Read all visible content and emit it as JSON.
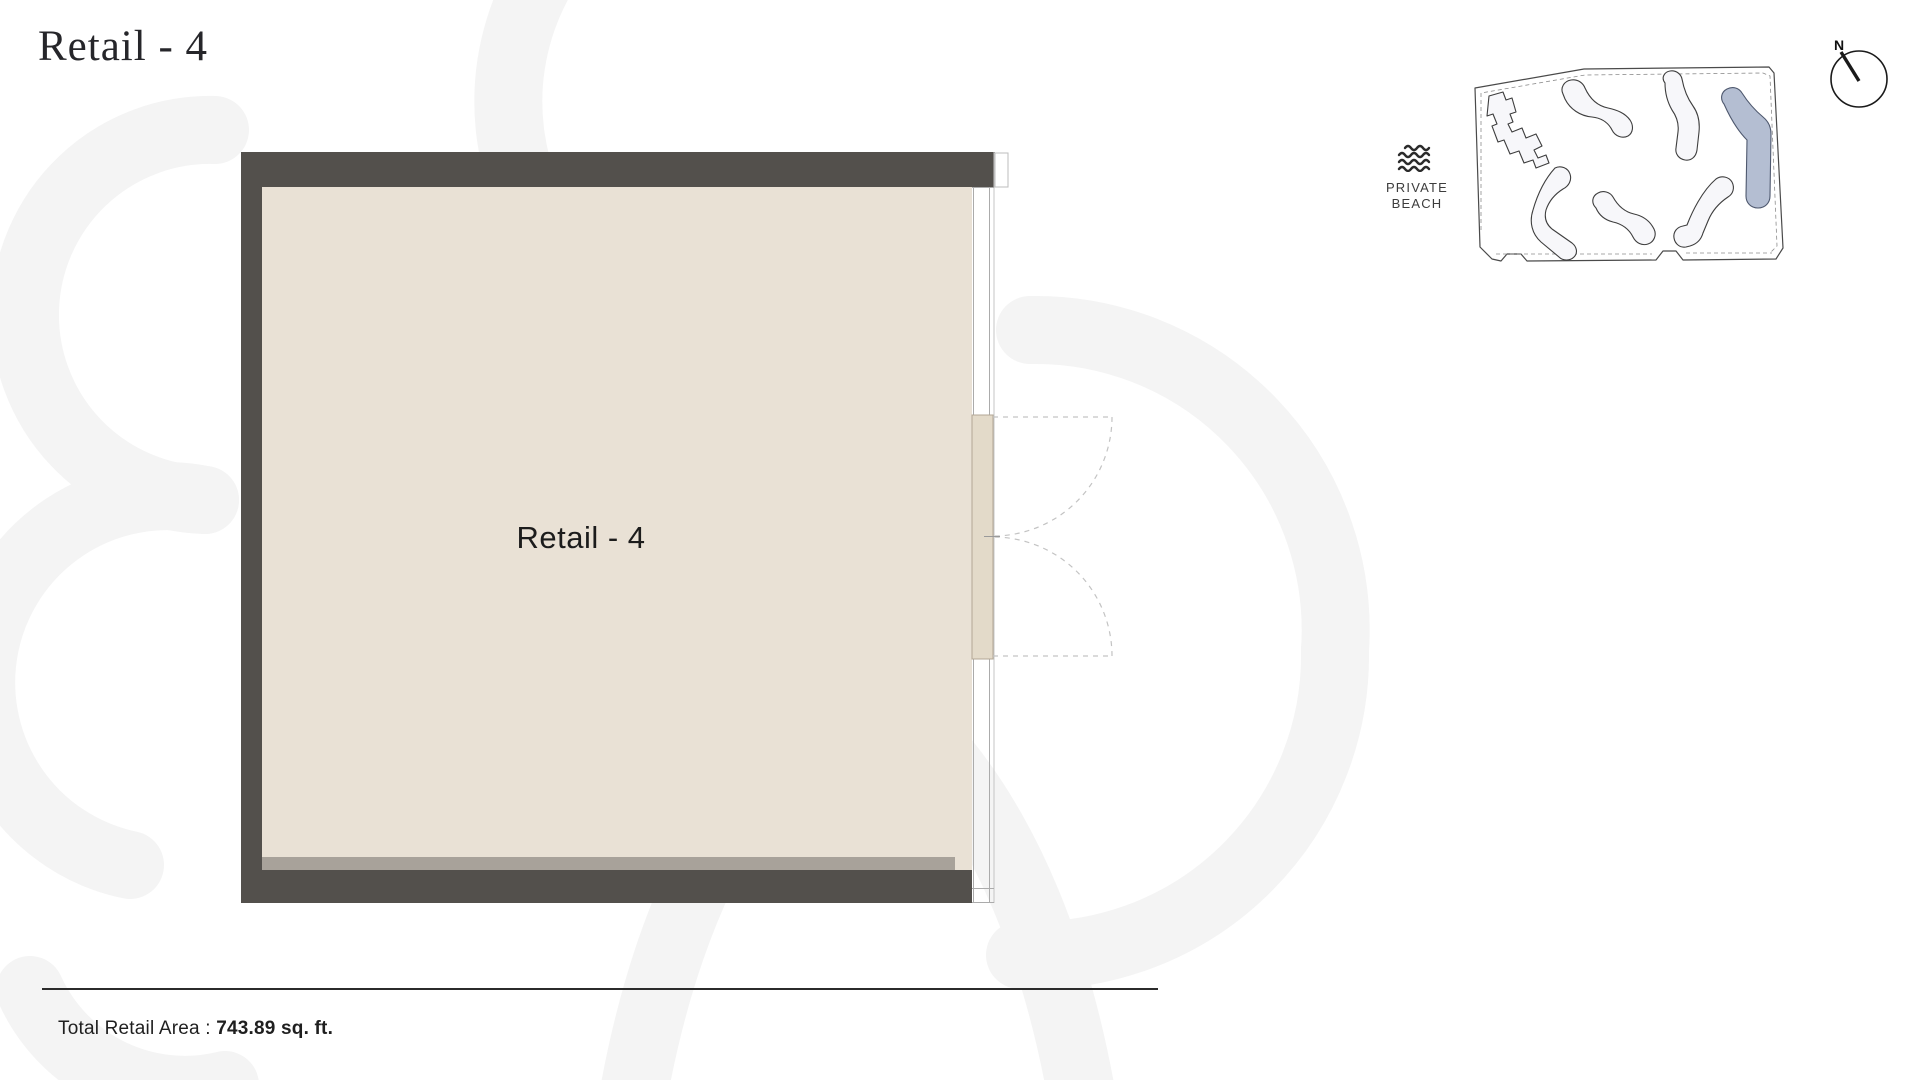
{
  "page": {
    "title": "Retail - 4"
  },
  "floor_plan": {
    "unit_label": "Retail - 4",
    "colors": {
      "wall": "#53504c",
      "floor": "#e9e1d5",
      "pier": "#e3dac9",
      "band": "#a8a29a",
      "glass_line": "#a5a5a5",
      "swing_dash": "#c3c3c3"
    }
  },
  "key_plan": {
    "compass_label": "N",
    "beach_label_line1": "PRIVATE",
    "beach_label_line2": "BEACH",
    "highlight_color": "#b4bed2",
    "building_fill": "#f7f7fa",
    "building_stroke": "#3e3e3e"
  },
  "footer": {
    "area_label": "Total Retail Area : ",
    "area_value": "743.89 sq. ft."
  }
}
